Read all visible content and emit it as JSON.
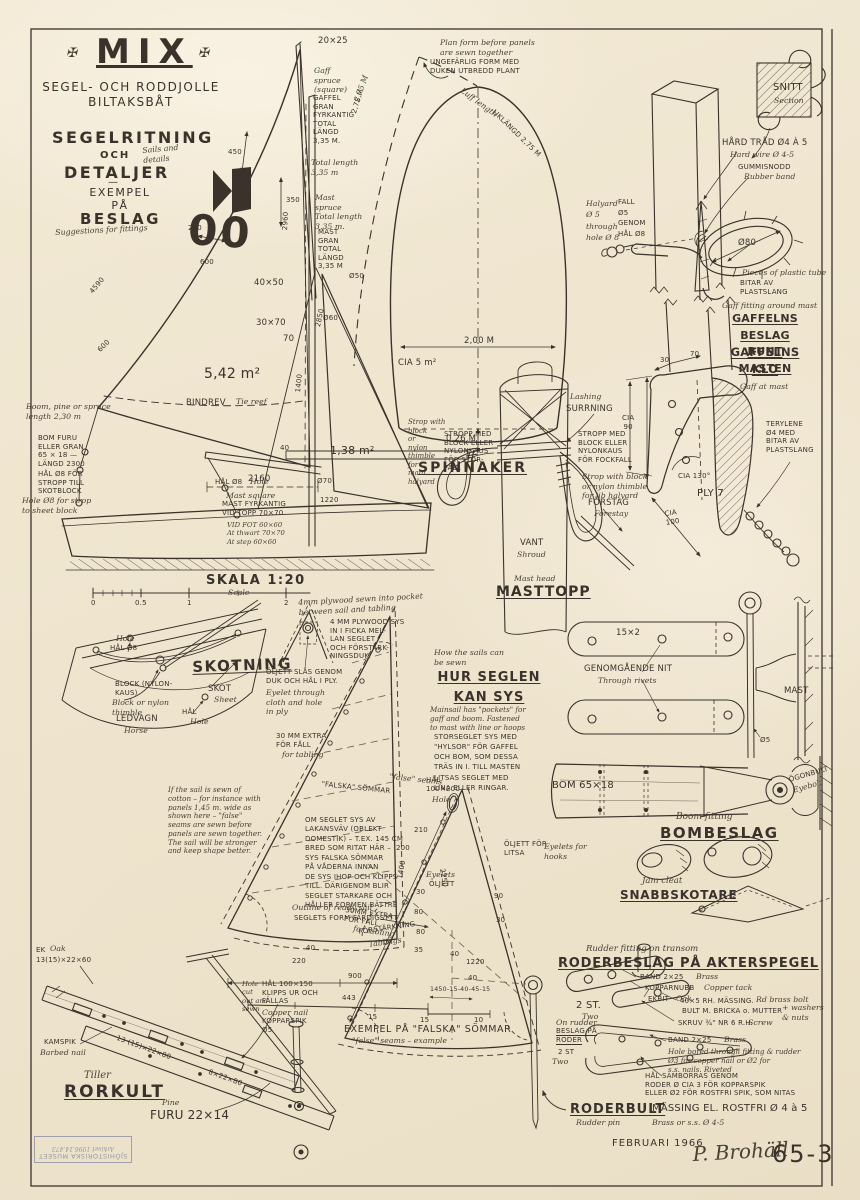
{
  "palette": {
    "paper": "#f2e9d4",
    "ink": "#3a322b",
    "stamp": "#878a9c"
  },
  "title_block": {
    "ornament": "✠",
    "title": "MIX",
    "subtitle": "SEGEL- OCH RODDJOLLE\nBILTAKSBÅT",
    "heading_a": "SEGELRITNING",
    "och": "OCH",
    "note_a": "Sails and\ndetails",
    "heading_b": "DETALJER",
    "heading_dash": "—",
    "heading_c": "EXEMPEL\nPÅ",
    "heading_d": "BESLAG",
    "note_b": "Suggestions for fittings"
  },
  "sail_plan": {
    "masthead_dim": "20×25",
    "gaff_cursive": "Gaff\nspruce\n(square)",
    "gaff_note": "GAFFEL\nGRAN\nFYRKANTIG\nTOTAL\nLÄNGD\n3,35 M.",
    "gaff_cursive2": "Total length\n3,35 m",
    "gaff_leech": "2,75 M",
    "mast_cursive": "Mast\nspruce\nTotal length\n3,35 m.",
    "mast_note": "MAST\nGRAN\nTOTAL\nLÄNGD\n3,35 M",
    "mast_dia": "Ø50",
    "sec_a": "40×50",
    "sec_b": "30×70",
    "dim70": "70",
    "dia60": "Ø60",
    "d2850": "2850",
    "d2960": "2960",
    "d450": "450",
    "d350": "350",
    "d200": "200",
    "d600a": "600",
    "d4590": "4590",
    "d600b": "600",
    "sail_no": "00",
    "area_main": "5,42 m²",
    "reef": "BINDREV",
    "reef_c": "Tie reef",
    "area_jib": "1,38 m²",
    "d40": "40",
    "boom_len": "2160",
    "d1400": "1400",
    "boom_c": "Boom, pine or spruce\nlength 2,30 m",
    "boom_note": "BOM FURU\nELLER GRAN\n65 × 18 —\nLÄNGD 2300",
    "boom_hole": "HÅL Ø8 FÖR\nSTROPP TILL\nSKOTBLOCK",
    "boom_hole_c": "Hole Ø8 for strop\nto sheet block",
    "mast_hole": "HÅL Ø8",
    "mast_hole_c": "Hole",
    "mast_sq_c": "Mast square",
    "mast_sq": "MAST FYRKANTIG\nVID TOPP 70×70",
    "mast_sq_s": "VID FOT 60×60\nAt thwart 70×70\nAt step 60×60",
    "jib_dia": "Ø70",
    "jib_foot": "1220",
    "scale": "SKALA 1:20",
    "scale_c": "Scale",
    "t0": "0",
    "t05": "0.5",
    "t1": "1",
    "t2": "2"
  },
  "spinnaker": {
    "plan_c": "Plan form before panels\nare sewn together",
    "plan": "UNGEFÄRLIG FORM MED\nDUKEN UTBREDD PLANT",
    "luff_c": "Luff length",
    "luff": "LIKLÄNGD 2,75 M",
    "left_dim": "2,75 M",
    "width": "2,00 M",
    "area": "CIA 5 m²",
    "foot": "0,26 M",
    "title": "SPINNAKER"
  },
  "gaff_fit": {
    "snitt": "SNITT",
    "snitt_c": "Section",
    "wire": "HÅRD TRÅD Ø4 À 5",
    "wire_c": "Hard wire Ø 4-5",
    "rubber": "GUMMISNODD",
    "rubber_c": "Rubber band",
    "ring": "Ø80",
    "tube_c": "Pieces of plastic tube",
    "tube": "BITAR AV\nPLASTSLANG",
    "title_c": "Gaff fitting around mast",
    "title": "GAFFELNS\nBESLAG RUNT\nMASTEN",
    "hal_c": "Halyard\nØ 5\nthrough\nhole Ø 8",
    "hal": "FALL\nØ5\nGENOM\nHÅL Ø8"
  },
  "claw": {
    "title": "GAFFELNS\nKLO",
    "title_c": "Gaff at mast",
    "d30": "30",
    "d70": "70",
    "cia90": "CIA\n90",
    "angle": "CIA 130°",
    "ply": "PLY 7",
    "cia100": "CIA\n100",
    "tery": "TERYLENE\nØ4 MED\nBITAR AV\nPLASTSLANG"
  },
  "masthead": {
    "lash_c": "Lashing",
    "lash": "SURRNING",
    "jib_strop": "STROPP MED\nBLOCK ELLER\nNYLONKAUS\nFÖR FOCKFALL",
    "jib_strop_c": "Strop with block\nor nylon thimble\nfor jib halyard",
    "main_strop_c": "Strop with\nblock\nor\nnylon\nthimble\nfor\nmain\nhalyard",
    "main_strop": "STROPP MED\nBLOCK ELLER\nNYLONKAUS\nFÖR STOR-\nFALL",
    "forestay": "FÖRSTAG",
    "forestay_c": "Forestay",
    "vant": "VANT",
    "vant_c": "Shroud",
    "title_c": "Mast head",
    "title": "MASTTOPP"
  },
  "sheeting": {
    "hole8_c": "Hole",
    "hole8": "HÅL Ø8",
    "title": "SKOTNING",
    "block": "BLOCK (NYLON-\nKAUS)",
    "block_c": "Block or nylon\nthimble",
    "skot": "SKOT",
    "skot_c": "Sheet",
    "hal": "HÅL",
    "hal_c": "Hole",
    "horse": "LEDVAGN",
    "horse_c": "Horse"
  },
  "sewing": {
    "intro_c": "How the sails can\nbe sewn",
    "title": "HUR SEGLEN\nKAN SYS",
    "body_c": "Mainsail has \"pockets\" for\ngaff and boom. Fastened\nto mast with line or hoops",
    "body": "STORSEGLET SYS MED\n\"HYLSOR\" FÖR GAFFEL\nOCH BOM, SOM DESSA\nTRÄS IN I. TILL MASTEN\nLITSAS SEGLET MED\nLINA ELLER RINGAR."
  },
  "details": {
    "ply_c": "4mm plywood sewn into pocket\nbetween sail and tabling",
    "ply": "4 MM PLYWOOD SYS\nIN I FICKA MEL-\nLAN SEGLET\nOCH FÖRSTÄRK-\nNINGSDUK-",
    "eyelet": "ÖLJETT SLÅS GENOM\nDUK OCH HÅL I PLY.",
    "eyelet_c": "Eyelet through\ncloth and hole\nin ply",
    "hem": "30 MM EXTRA\nFÖR FÅLL",
    "hem_c": "for tabling",
    "hole": "HÅL\n100×200",
    "hole_c": "Hole",
    "fseam": "\"FALSKA\" SÖMMAR",
    "fseam_c": "\"false\" seams",
    "cotton_c": "If the sail is sewn of\ncotton – for instance with\npanels 1,45 m. wide as\nshown here – \"false\"\nseams are sewn before\npanels are sewn together.\nThe sail will be stronger\nand keep shape better.",
    "panel_note": "OM SEGLET SYS AV\nLAKANSVÄV (OBLEKT\nDOMESTIK) – T.EX. 145 CM\nBRED SOM RITAT HÄR –\nSYS FALSKA SÖMMAR\nPÅ VÅDERNA INNAN\nDE SYS IHOP OCH KLIPPS\nTILL. DÄRIGENOM BLIR\nSEGLET STARKARE OCH\nHÅLLER FORMEN BÄTTRE",
    "outline_c": "Outline of ready sail",
    "outline": "SEGLETS FORM FÄRDIGSYTT",
    "tabl": "FÖRSTÄRKNING",
    "tabl_c": "Tablings",
    "eyelets_c": "Eyelets",
    "eyelets": "ÖLJETT",
    "d210": "210",
    "d200": "200",
    "d30a": "30",
    "d80a": "80",
    "d80b": "80",
    "d35": "35",
    "d40a": "40",
    "d220": "220",
    "d900": "900",
    "d1400": "1400",
    "jib_eyelets": "ÖLJETT FÖR\nLITSA",
    "jib_eyelets_c": "Eyelets for\nhooks",
    "jib_luff": "2250",
    "jib_hem": "30MM EXTRA\nFÖR FÅLL",
    "jib_hem_c": "for tabling",
    "d90": "90",
    "d30b": "30",
    "d40b": "40",
    "d1220": "1220",
    "d40c": "40"
  },
  "example": {
    "d443": "443",
    "formula": "1450-15-40-45-15",
    "d15a": "15",
    "d15b": "15",
    "d10": "10",
    "caption": "EXEMPEL PÅ \"FALSKA\" SÖMMAR",
    "caption_c": "\"false\" seams – example"
  },
  "boomfit": {
    "band": "15×2",
    "rivet": "GENOMGÅENDE NIT",
    "rivet_c": "Through rivets",
    "mast": "MAST",
    "dia5": "Ø5",
    "bom": "BOM 65×18",
    "eye": "ÖGONBULT",
    "eye_c": "Eyebolt",
    "title_c": "Boom fitting",
    "title": "BOMBESLAG"
  },
  "cleat": {
    "title_c": "Jam cleat",
    "title": "SNABBSKOTARE"
  },
  "rudder": {
    "title_c": "Rudder fitting on transom",
    "title": "RODERBESLAG PÅ AKTERSPEGEL",
    "band_a": "BAND 2×25",
    "band_a_c": "Brass",
    "nubb": "KOPPARNUBB",
    "nubb_c": "Copper tack",
    "oak": "EKBIT",
    "oak_c": "Oak",
    "bolt": "40×5 RH. MÄSSING.",
    "bolt_c": "Rd brass bolt",
    "bolt2": "BULT M. BRICKA o. MUTTER",
    "bolt2_c": "+ washers\n& nuts",
    "screw": "SKRUV ¾\" NR 6 R.H.",
    "screw_c": "Screw",
    "qty": "2 ST.",
    "qty_c": "Two",
    "onr_c": "On rudder",
    "onr": "BESLAG PÅ\nRODER",
    "qty2": "2 ST",
    "qty2_c": "Two",
    "band_b": "BAND 2×25",
    "band_b_c": "Brass",
    "hole_c": "Hole bored through fitting & rudder\nØ3 for copper nail or Ø2 for\ns.s. nails.  Riveted",
    "hole": "HÅL SAMBORRAS GENOM\nRODER Ø CIA 3 FÖR KOPPARSPIK\nELLER Ø2 FÖR ROSTFRI SPIK, SOM NITAS",
    "pin": "RODERBULT",
    "pin_note": "MÄSSING EL. ROSTFRI Ø 4 à 5",
    "pin_c": "Rudder pin",
    "pin_note_c": "Brass or s.s.  Ø 4-5"
  },
  "tiller": {
    "oak": "EK",
    "oak_c": "Oak",
    "oak_dim": "13(15)×22×60",
    "nail": "KAMSPIK",
    "nail_c": "Barbed nail",
    "bar1": "13 (15)×22×80",
    "bar2": "8×22×80",
    "title_c": "Tiller",
    "title": "RORKULT",
    "pine_c": "Pine",
    "pine": "FURU 22×14",
    "cut_c": "Hole\ncut\nout and\nsewn",
    "cut": "HÅL 100×150\nKLIPPS UR OCH\nFÄLLAS",
    "nail2_c": "Copper nail",
    "nail2": "KOPPARSPIK\nØ5"
  },
  "footer": {
    "date": "FEBRUARI 1966",
    "sign": "P. Brohäll",
    "no": "65-3"
  },
  "stamp": {
    "l1": "SJÖHISTORISKA MUSEET",
    "l2": "Arkivet 1996.14.473"
  }
}
